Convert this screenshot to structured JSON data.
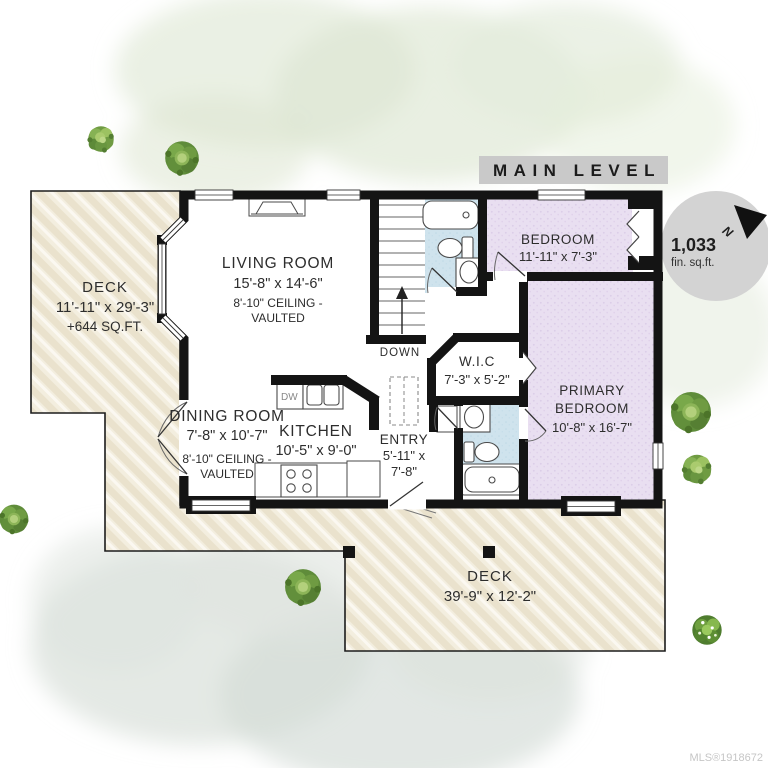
{
  "header": {
    "title": "MAIN LEVEL"
  },
  "compass": {
    "area_value": "1,033",
    "area_unit": "fin. sq.ft.",
    "north_label": "N"
  },
  "watermark": {
    "mls": "MLS®1918672"
  },
  "rooms": {
    "living": {
      "name": "LIVING ROOM",
      "dims": "15'-8\" x 14'-6\"",
      "ceiling1": "8'-10\" CEILING -",
      "ceiling2": "VAULTED"
    },
    "dining": {
      "name": "DINING ROOM",
      "dims": "7'-8\" x 10'-7\"",
      "ceiling1": "8'-10\" CEILING -",
      "ceiling2": "VAULTED"
    },
    "kitchen": {
      "name": "KITCHEN",
      "dims": "10'-5\" x 9'-0\""
    },
    "entry": {
      "name": "ENTRY",
      "dims_line1": "5'-11\" x",
      "dims_line2": "7'-8\""
    },
    "wic": {
      "name": "W.I.C",
      "dims": "7'-3\" x 5'-2\""
    },
    "bedroom": {
      "name": "BEDROOM",
      "dims": "11'-11\" x 7'-3\""
    },
    "primary": {
      "name_line1": "PRIMARY",
      "name_line2": "BEDROOM",
      "dims": "10'-8\" x 16'-7\""
    },
    "deck_left": {
      "name": "DECK",
      "dims": "11'-11\" x 29'-3\"",
      "extra": "+644 SQ.FT."
    },
    "deck_bottom": {
      "name": "DECK",
      "dims": "39'-9\" x 12'-2\""
    }
  },
  "stairs": {
    "label": "DOWN"
  },
  "kitchen_fixtures": {
    "dishwasher_label": "DW"
  },
  "colors": {
    "wall": "#141414",
    "deck_fill": "#f3eedf",
    "deck_stripe": "#eae2cd",
    "bedroom_fill": "#e9dff1",
    "bath_fill": "#cfe3ed",
    "header_bar": "#c9c9c9",
    "compass_circle": "#d3d3d3",
    "tree_green": "#6f9b42"
  }
}
